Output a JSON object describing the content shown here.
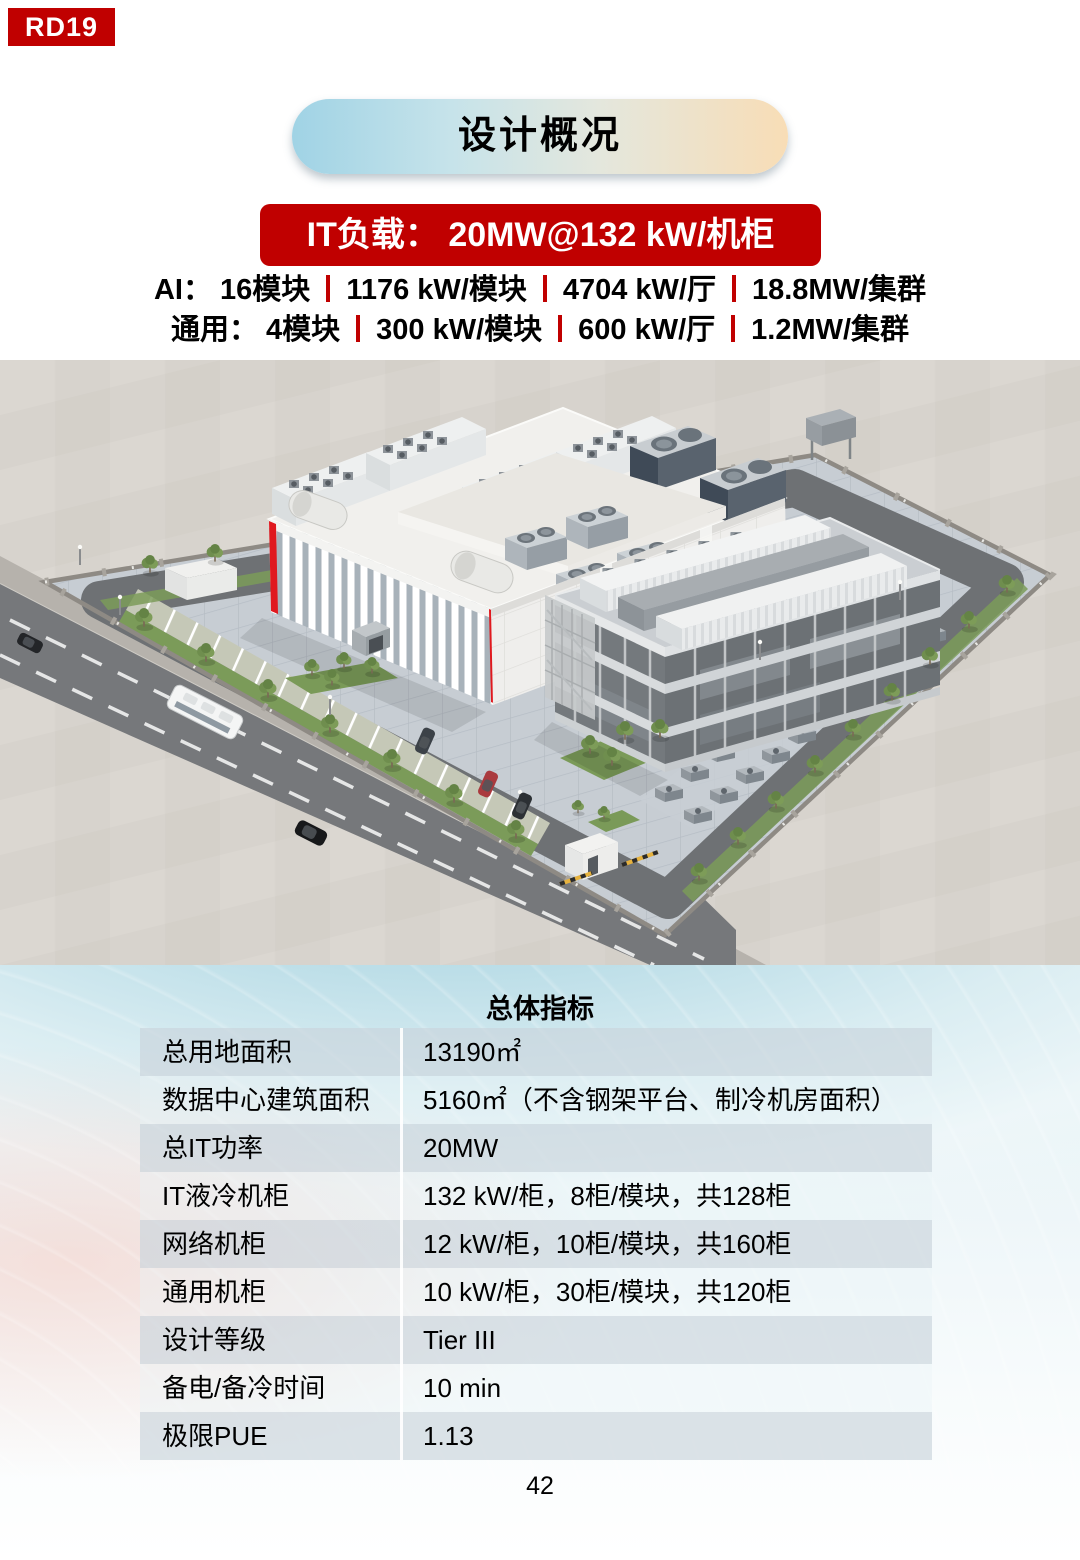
{
  "header": {
    "badge": "RD19",
    "title": "设计概况",
    "banner": "IT负载： 20MW@132 kW/机柜",
    "spec_lines": [
      {
        "segments": [
          "AI： 16模块",
          "1176 kW/模块",
          "4704 kW/厅",
          "18.8MW/集群"
        ]
      },
      {
        "segments": [
          "通用： 4模块",
          "300 kW/模块",
          "600 kW/厅",
          "1.2MW/集群"
        ]
      }
    ]
  },
  "table": {
    "title": "总体指标",
    "rows": [
      {
        "label": "总用地面积",
        "value": "13190㎡"
      },
      {
        "label": "数据中心建筑面积",
        "value": "5160㎡（不含钢架平台、制冷机房面积）"
      },
      {
        "label": "总IT功率",
        "value": "20MW"
      },
      {
        "label": "IT液冷机柜",
        "value": "132 kW/柜，8柜/模块，共128柜"
      },
      {
        "label": "网络机柜",
        "value": "12 kW/柜，10柜/模块，共160柜"
      },
      {
        "label": "通用机柜",
        "value": "10 kW/柜，30柜/模块，共120柜"
      },
      {
        "label": "设计等级",
        "value": "Tier III"
      },
      {
        "label": "备电/备冷时间",
        "value": "10 min"
      },
      {
        "label": "极限PUE",
        "value": "1.13"
      }
    ]
  },
  "footer": {
    "page_number": "42"
  },
  "colors": {
    "accent_red": "#c00000",
    "building_accent_red": "#e0191f",
    "pill_gradient_start": "#a0d3e5",
    "pill_gradient_end": "#f8ddb6"
  }
}
